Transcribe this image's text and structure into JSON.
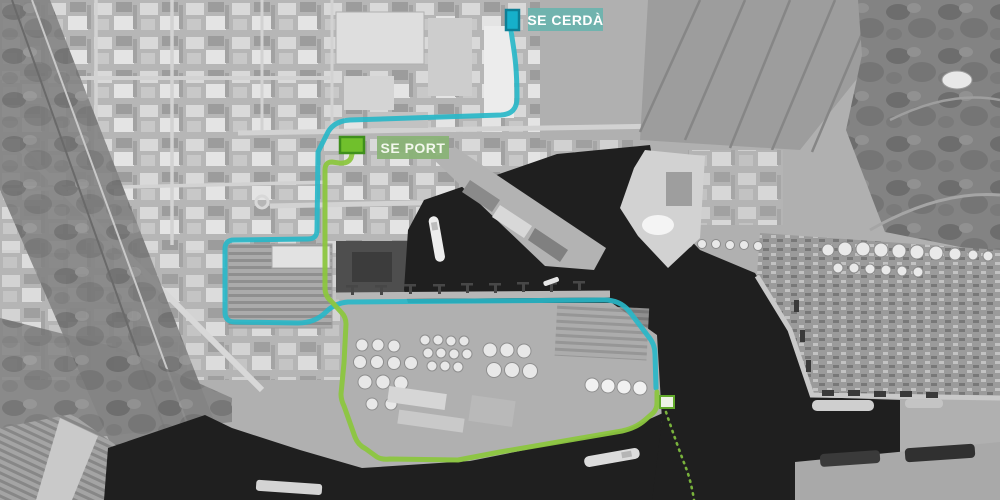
{
  "map": {
    "labels": {
      "se_cerda": "SE CERDÀ",
      "se_port": "SE PORT"
    },
    "colors": {
      "cerda_route": "#29b7c8",
      "cerda_marker_fill": "#16b0cb",
      "cerda_marker_border": "#0d7e95",
      "cerda_label_bg": "#6db3ae",
      "cerda_label_text": "#ffffff",
      "port_route": "#8cc63f",
      "port_marker_fill": "#70c02c",
      "port_marker_border": "#3f8f1c",
      "port_label_bg": "#8ab377",
      "port_label_text": "#f3f8ed",
      "planned_route": "#79b33c",
      "junction_marker_fill": "#eef3e6",
      "junction_marker_border": "#62aa2b",
      "water": "#1f1f1f"
    }
  }
}
